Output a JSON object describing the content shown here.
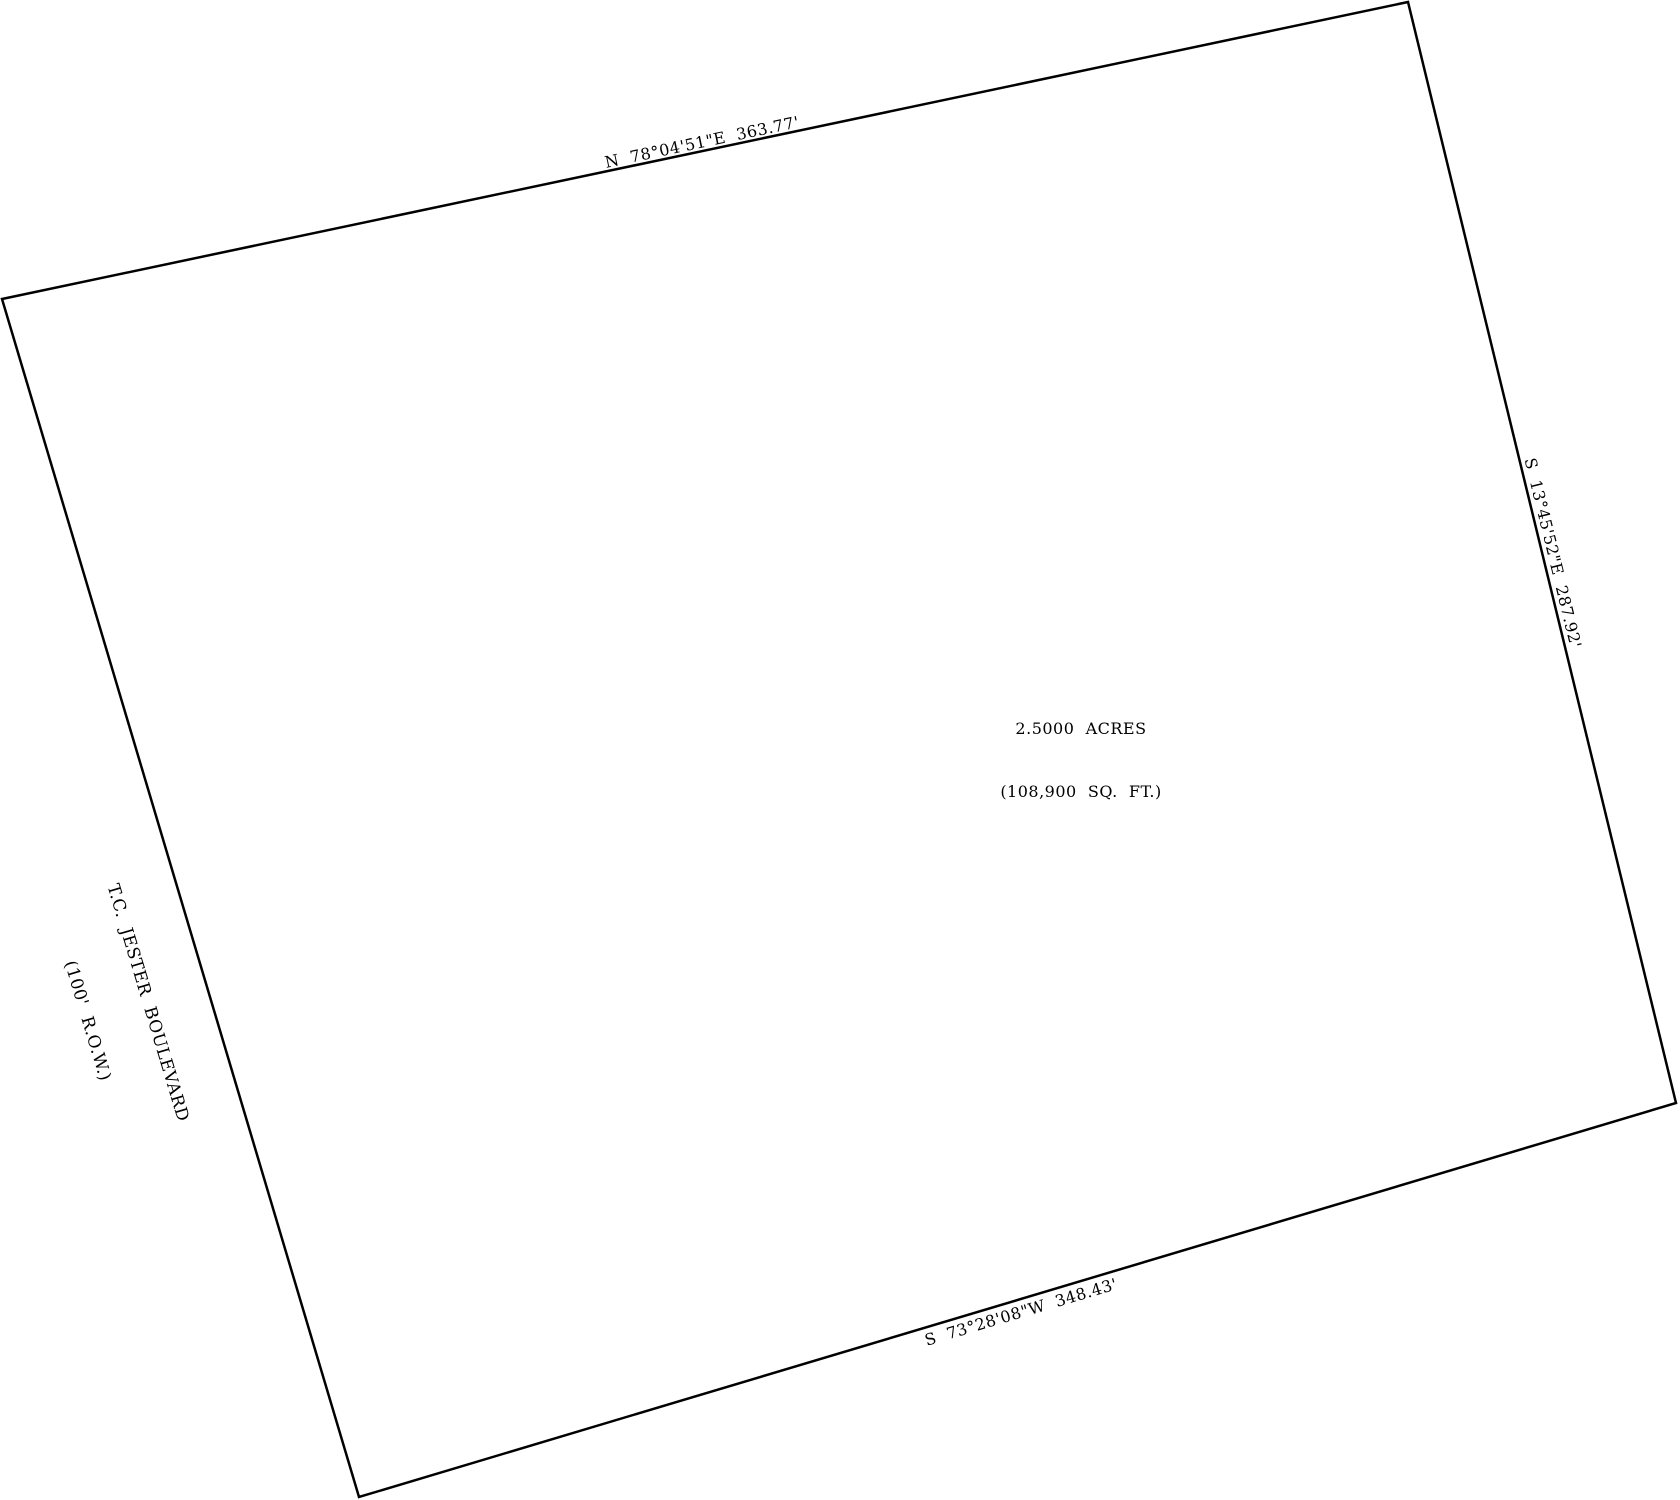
{
  "document": {
    "type": "boundary-survey-plat",
    "background_color": "#ffffff",
    "line_color": "#000000",
    "text_color": "#000000"
  },
  "parcel": {
    "area": {
      "line1": "2.5000  ACRES",
      "line2": "(108,900  SQ.  FT.)"
    },
    "boundaries": [
      {
        "side": "north",
        "label": "N  78°04'51\"E  363.77'"
      },
      {
        "side": "east",
        "label": "S  13°45'52\"E  287.92'"
      },
      {
        "side": "south",
        "label": "S  73°28'08\"W  348.43'"
      }
    ],
    "street": {
      "name": "T.C.  JESTER  BOULEVARD",
      "row": "(100'  R.O.W.)"
    }
  }
}
